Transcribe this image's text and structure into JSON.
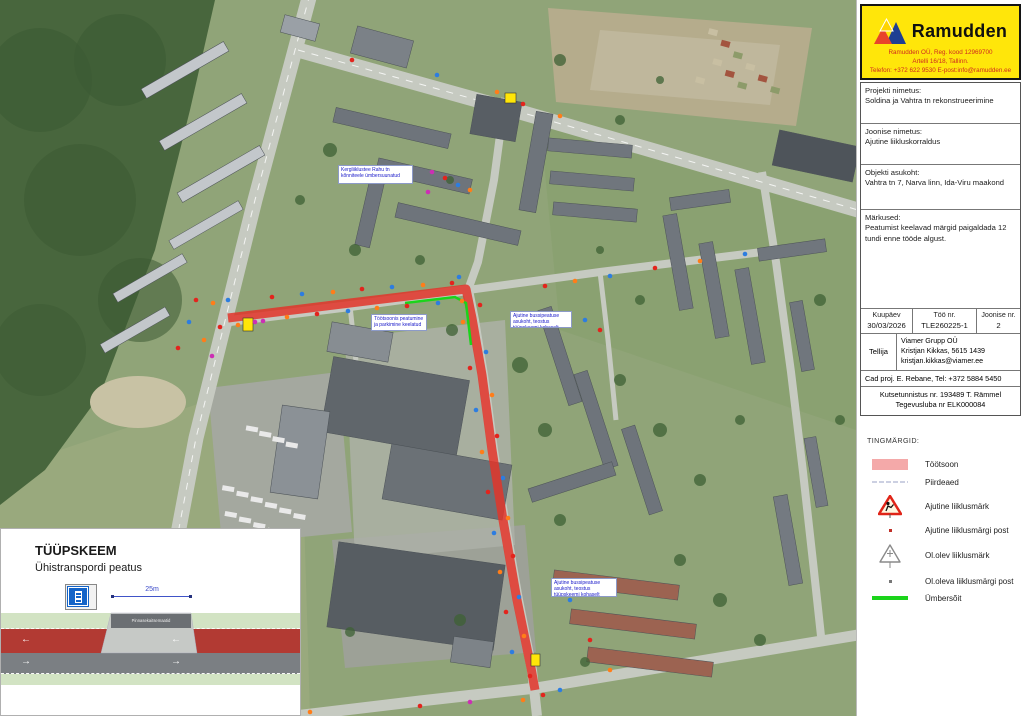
{
  "title_block": {
    "logo": {
      "brand": "Ramudden",
      "line1": "Ramudden OÜ, Reg. kood 12969700",
      "line2": "Artelli 16/18, Tallinn.",
      "line3": "Telefon: +372 622 9530  E-post:info@ramudden.ee"
    },
    "project_label": "Projekti nimetus:",
    "project_value": "Soldina ja Vahtra tn rekonstrueerimine",
    "drawing_label": "Joonise nimetus:",
    "drawing_value": "Ajutine liikluskorraldus",
    "location_label": "Objekti asukoht:",
    "location_value": "Vahtra tn 7, Narva linn, Ida-Viru maakond",
    "notes_label": "Märkused:",
    "notes_value": "Peatumist keelavad märgid paigaldada 12 tundi enne tööde algust.",
    "table": {
      "date_label": "Kuupäev",
      "date_value": "30/03/2026",
      "work_label": "Töö nr.",
      "work_value": "TLE260225-1",
      "sheet_label": "Joonise nr.",
      "sheet_value": "2"
    },
    "client_label": "Tellija",
    "client_lines": [
      "Viamer Grupp OÜ",
      "Kristjan Kikkas, 5615 1439",
      "kristjan.kikkas@viamer.ee"
    ],
    "cad_label": "Cad proj.",
    "cad_value": "E. Rebane, Tel: +372 5884 5450",
    "cert_line1": "Kutsetunnistus nr. 193489 T. Rämmel",
    "cert_line2": "Tegevusluba nr ELK000084"
  },
  "legend": {
    "title": "TINGMÄRGID:",
    "items": [
      {
        "icon": "workzone-swatch",
        "label": "Töötsoon"
      },
      {
        "icon": "fence-line",
        "label": "Piirdeaed"
      },
      {
        "icon": "temporary-roadworks-sign",
        "label": "Ajutine liiklusmärk"
      },
      {
        "icon": "temporary-sign-post-dot",
        "label": "Ajutine liiklusmärgi post"
      },
      {
        "icon": "existing-sign-triangle",
        "label": "Ol.olev liiklusmärk"
      },
      {
        "icon": "existing-sign-post-dot",
        "label": "Ol.oleva liiklusmärgi post"
      },
      {
        "icon": "detour-line",
        "label": "Ümbersõit"
      }
    ]
  },
  "inset": {
    "title": "TÜÜPSKEEM",
    "subtitle": "Ühistranspordi peatus",
    "dimension_label": "25m",
    "platform_label": "Pinnasekaitsemaatid"
  },
  "map_labels": [
    {
      "text": "Kergliiklustee Rahu tn kõnniteele ümbersuunatud"
    },
    {
      "text": "Töötsoonis peatumine ja parkimine keelatud"
    },
    {
      "text": "Ajutine bussipeatuse asukoht, teostus tüüpskeemi kohaselt"
    },
    {
      "text": "Ajutine bussipeatuse asukoht, teostus tüüpskeemi kohaselt"
    }
  ],
  "colors": {
    "workzone": "#e2352a",
    "detour": "#1bd41b",
    "legend_workzone": "#f4a9a9"
  },
  "map": {
    "marker_colors": {
      "r": "#e3241d",
      "o": "#ff7d19",
      "b": "#2d7de0",
      "m": "#cc2fb4"
    },
    "markers": [
      {
        "x": 213,
        "y": 303,
        "c": "o"
      },
      {
        "x": 220,
        "y": 327,
        "c": "r"
      },
      {
        "x": 228,
        "y": 300,
        "c": "b"
      },
      {
        "x": 238,
        "y": 325,
        "c": "o"
      },
      {
        "x": 255,
        "y": 322,
        "c": "m"
      },
      {
        "x": 263,
        "y": 321,
        "c": "m"
      },
      {
        "x": 272,
        "y": 297,
        "c": "r"
      },
      {
        "x": 287,
        "y": 317,
        "c": "o"
      },
      {
        "x": 302,
        "y": 294,
        "c": "b"
      },
      {
        "x": 317,
        "y": 314,
        "c": "r"
      },
      {
        "x": 333,
        "y": 292,
        "c": "o"
      },
      {
        "x": 348,
        "y": 311,
        "c": "b"
      },
      {
        "x": 362,
        "y": 289,
        "c": "r"
      },
      {
        "x": 377,
        "y": 308,
        "c": "o"
      },
      {
        "x": 392,
        "y": 287,
        "c": "b"
      },
      {
        "x": 407,
        "y": 306,
        "c": "r"
      },
      {
        "x": 423,
        "y": 285,
        "c": "o"
      },
      {
        "x": 438,
        "y": 303,
        "c": "b"
      },
      {
        "x": 452,
        "y": 283,
        "c": "r"
      },
      {
        "x": 462,
        "y": 301,
        "c": "o"
      },
      {
        "x": 459,
        "y": 277,
        "c": "b"
      },
      {
        "x": 480,
        "y": 305,
        "c": "r"
      },
      {
        "x": 463,
        "y": 322,
        "c": "o"
      },
      {
        "x": 486,
        "y": 352,
        "c": "b"
      },
      {
        "x": 470,
        "y": 368,
        "c": "r"
      },
      {
        "x": 492,
        "y": 395,
        "c": "o"
      },
      {
        "x": 476,
        "y": 410,
        "c": "b"
      },
      {
        "x": 497,
        "y": 436,
        "c": "r"
      },
      {
        "x": 482,
        "y": 452,
        "c": "o"
      },
      {
        "x": 503,
        "y": 478,
        "c": "b"
      },
      {
        "x": 488,
        "y": 492,
        "c": "r"
      },
      {
        "x": 508,
        "y": 518,
        "c": "o"
      },
      {
        "x": 494,
        "y": 533,
        "c": "b"
      },
      {
        "x": 513,
        "y": 556,
        "c": "r"
      },
      {
        "x": 500,
        "y": 572,
        "c": "o"
      },
      {
        "x": 519,
        "y": 597,
        "c": "b"
      },
      {
        "x": 506,
        "y": 612,
        "c": "r"
      },
      {
        "x": 524,
        "y": 636,
        "c": "o"
      },
      {
        "x": 512,
        "y": 652,
        "c": "b"
      },
      {
        "x": 530,
        "y": 676,
        "c": "r"
      },
      {
        "x": 497,
        "y": 92,
        "c": "o"
      },
      {
        "x": 523,
        "y": 104,
        "c": "r"
      },
      {
        "x": 560,
        "y": 116,
        "c": "o"
      },
      {
        "x": 437,
        "y": 75,
        "c": "b"
      },
      {
        "x": 352,
        "y": 60,
        "c": "r"
      },
      {
        "x": 545,
        "y": 286,
        "c": "r"
      },
      {
        "x": 575,
        "y": 281,
        "c": "o"
      },
      {
        "x": 610,
        "y": 276,
        "c": "b"
      },
      {
        "x": 655,
        "y": 268,
        "c": "r"
      },
      {
        "x": 700,
        "y": 261,
        "c": "o"
      },
      {
        "x": 745,
        "y": 254,
        "c": "b"
      },
      {
        "x": 196,
        "y": 300,
        "c": "r"
      },
      {
        "x": 189,
        "y": 322,
        "c": "b"
      },
      {
        "x": 204,
        "y": 340,
        "c": "o"
      },
      {
        "x": 178,
        "y": 348,
        "c": "r"
      },
      {
        "x": 212,
        "y": 356,
        "c": "m"
      },
      {
        "x": 432,
        "y": 172,
        "c": "m"
      },
      {
        "x": 445,
        "y": 178,
        "c": "r"
      },
      {
        "x": 458,
        "y": 185,
        "c": "b"
      },
      {
        "x": 470,
        "y": 190,
        "c": "o"
      },
      {
        "x": 428,
        "y": 192,
        "c": "m"
      },
      {
        "x": 543,
        "y": 695,
        "c": "r"
      },
      {
        "x": 523,
        "y": 700,
        "c": "o"
      },
      {
        "x": 560,
        "y": 690,
        "c": "b"
      },
      {
        "x": 470,
        "y": 702,
        "c": "m"
      },
      {
        "x": 420,
        "y": 706,
        "c": "r"
      },
      {
        "x": 310,
        "y": 712,
        "c": "o"
      },
      {
        "x": 585,
        "y": 320,
        "c": "b"
      },
      {
        "x": 600,
        "y": 330,
        "c": "r"
      },
      {
        "x": 570,
        "y": 600,
        "c": "b"
      },
      {
        "x": 590,
        "y": 640,
        "c": "r"
      },
      {
        "x": 610,
        "y": 670,
        "c": "o"
      }
    ]
  }
}
